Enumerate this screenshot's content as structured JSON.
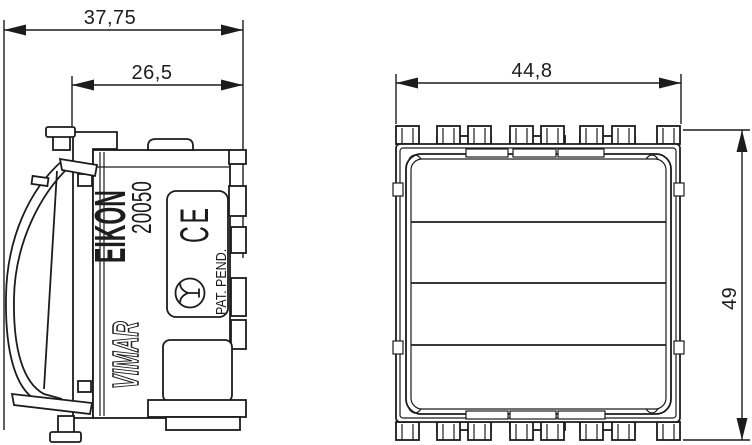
{
  "palette": {
    "background": "#ffffff",
    "ink": "#1c1c1c"
  },
  "side_view": {
    "dimensions": {
      "overall_depth_mm": "37,75",
      "recess_depth_mm": "26,5"
    },
    "markings": {
      "brand": "EIKON",
      "model": "20050",
      "logo": "VIMAR",
      "patent": "PAT. PEND.",
      "ce": "CE"
    }
  },
  "front_view": {
    "dimensions": {
      "width_mm": "44,8",
      "height_mm": "49"
    }
  }
}
